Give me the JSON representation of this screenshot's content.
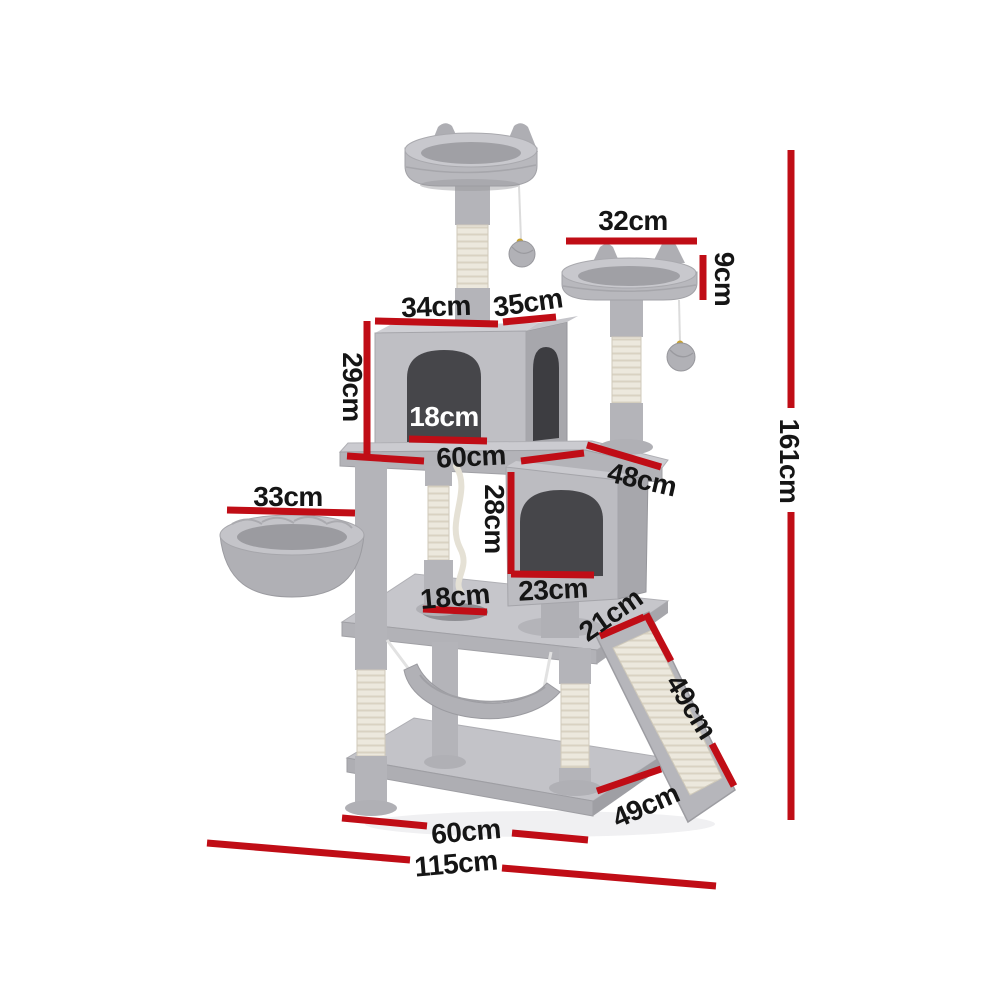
{
  "colors": {
    "dimension_red": "#c00d16",
    "label_black": "#151515",
    "plush_gray": "#bcbcc1",
    "sisal_cream": "#ece8dd",
    "background": "#ffffff"
  },
  "dims": {
    "top_perch_width": "32cm",
    "top_perch_height": "9cm",
    "upper_condo_width": "34cm",
    "upper_condo_depth": "35cm",
    "upper_condo_height": "29cm",
    "upper_condo_door_width": "18cm",
    "middle_platform_width": "60cm",
    "lower_condo_width": "48cm",
    "basket_width": "33cm",
    "lower_condo_door_height": "28cm",
    "lower_condo_door_width": "23cm",
    "platform_hole_diameter": "18cm",
    "ramp_top_width": "21cm",
    "ramp_length": "49cm",
    "total_height": "161cm",
    "base_width": "60cm",
    "base_depth": "49cm",
    "overall_width": "115cm"
  }
}
